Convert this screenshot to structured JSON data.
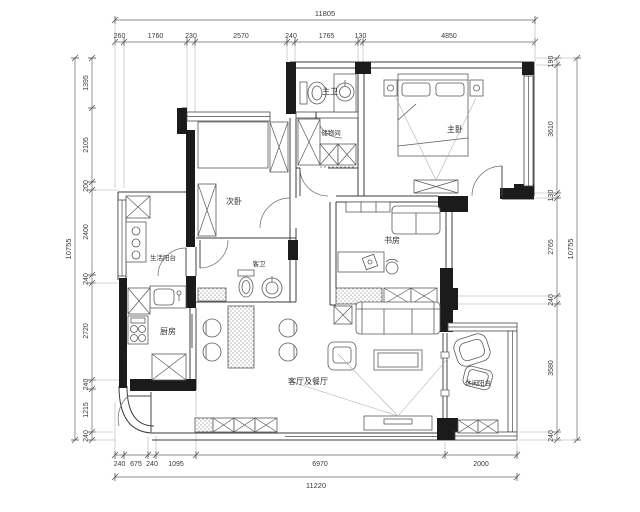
{
  "drawing": {
    "title": "apartment floor plan",
    "rooms": {
      "master_bath": "主卫",
      "storage": "储物间",
      "master_bedroom": "主卧",
      "second_bedroom": "次卧",
      "study": "书房",
      "service_balcony": "生活阳台",
      "guest_bath": "客卫",
      "kitchen": "厨房",
      "living_dining": "客厅及餐厅",
      "leisure_balcony": "休闲阳台"
    },
    "dims": {
      "top": {
        "total": "11805",
        "segments": [
          "260",
          "1760",
          "230",
          "2570",
          "240",
          "1765",
          "130",
          "4850"
        ]
      },
      "bottom": {
        "total": "11220",
        "segments": [
          "240",
          "675",
          "240",
          "1095",
          "6970",
          "2000"
        ]
      },
      "left": {
        "total": "10755",
        "segments": [
          "1395",
          "2105",
          "200",
          "2400",
          "240",
          "2720",
          "240",
          "1215",
          "240"
        ]
      },
      "right": {
        "total": "10755",
        "segments": [
          "190",
          "3610",
          "130",
          "2765",
          "240",
          "3580",
          "240"
        ]
      }
    },
    "colors": {
      "wall": "#1b1b1b",
      "line": "#555555",
      "background": "#ffffff"
    }
  }
}
